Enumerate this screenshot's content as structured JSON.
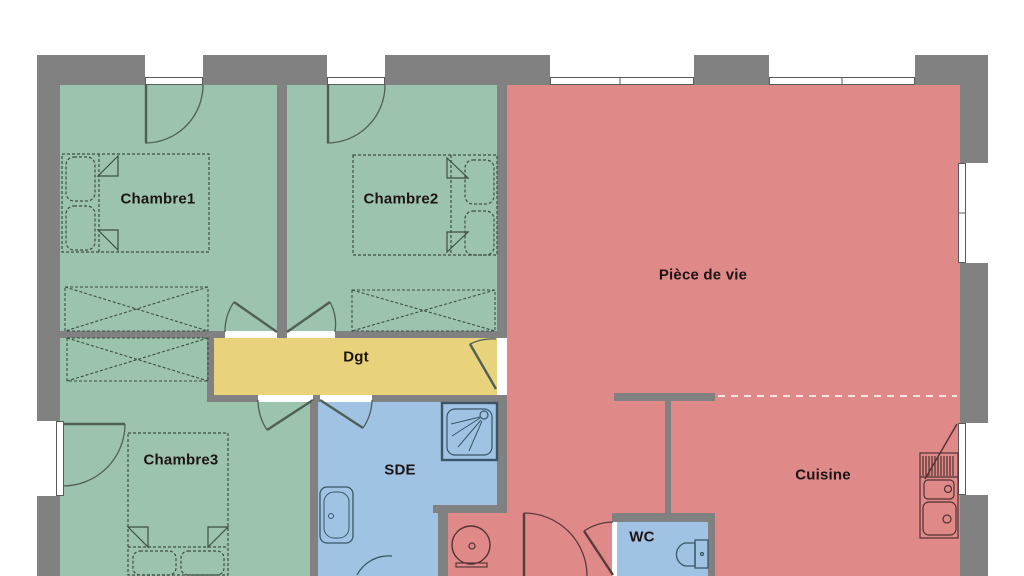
{
  "floorplan": {
    "rooms": {
      "chambre1": {
        "label": "Chambre1",
        "color": "#9cc3ad"
      },
      "chambre2": {
        "label": "Chambre2",
        "color": "#9cc3ad"
      },
      "chambre3": {
        "label": "Chambre3",
        "color": "#9cc3ad"
      },
      "piece_de_vie": {
        "label": "Pièce de vie",
        "color": "#df8989"
      },
      "entree": {
        "label": "",
        "color": "#df8989"
      },
      "cuisine": {
        "label": "Cuisine",
        "color": "#df8989"
      },
      "dgt": {
        "label": "Dgt",
        "color": "#e8d37c"
      },
      "sde": {
        "label": "SDE",
        "color": "#a0c3e4"
      },
      "wc": {
        "label": "WC",
        "color": "#a0c3e4"
      }
    },
    "colors": {
      "wall": "#818181",
      "window": "#ffffff",
      "furniture_outline_green": "#3c4f44",
      "furniture_outline_blue": "#3a5666",
      "furniture_outline_red": "#4f3232",
      "door_swing": "#4f5f55",
      "label_text": "#1d1414"
    }
  }
}
